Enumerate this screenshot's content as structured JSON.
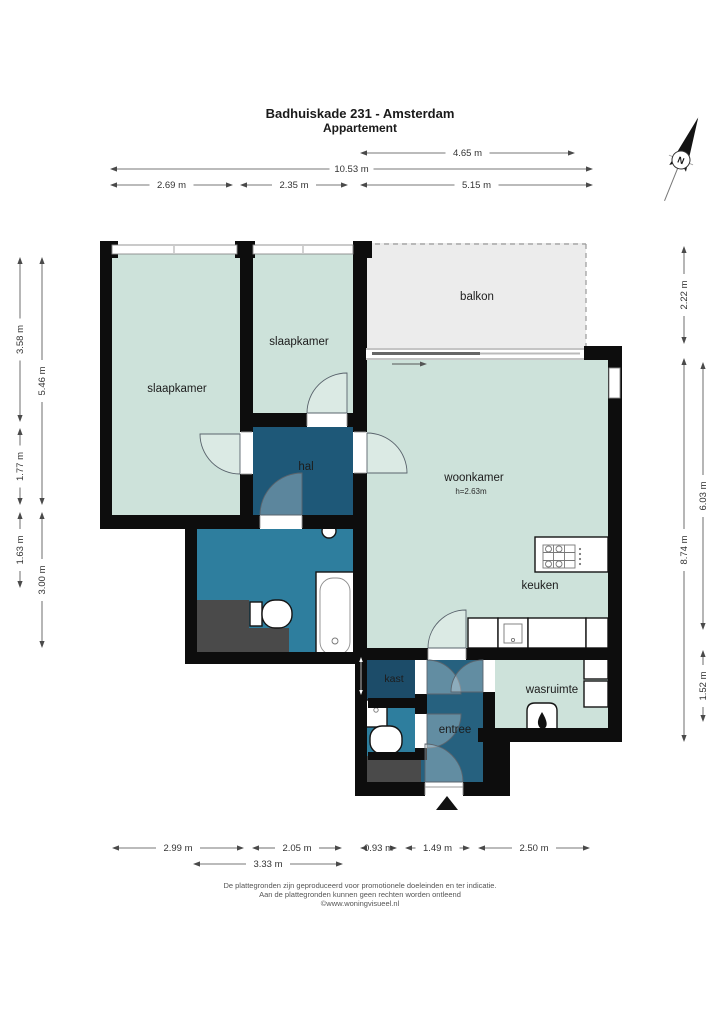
{
  "title": {
    "line1": "Badhuiskade 231 - Amsterdam",
    "line2": "Appartement"
  },
  "compass": {
    "north_letter": "N"
  },
  "rooms": {
    "slaapkamer1": {
      "label": "slaapkamer"
    },
    "slaapkamer2": {
      "label": "slaapkamer"
    },
    "balkon": {
      "label": "balkon"
    },
    "woonkamer": {
      "label": "woonkamer",
      "ceiling_height": "h=2.63m"
    },
    "hal": {
      "label": "hal"
    },
    "keuken": {
      "label": "keuken"
    },
    "kast": {
      "label": "kast"
    },
    "entree": {
      "label": "entree"
    },
    "wasruimte": {
      "label": "wasruimte"
    }
  },
  "dimensions": {
    "top": [
      {
        "label": "4.65 m"
      },
      {
        "label": "10.53 m"
      },
      {
        "label": "2.69 m"
      },
      {
        "label": "2.35 m"
      },
      {
        "label": "5.15 m"
      }
    ],
    "left": [
      {
        "label": "3.58 m"
      },
      {
        "label": "1.77 m"
      },
      {
        "label": "1.63 m"
      },
      {
        "label": "5.46 m"
      },
      {
        "label": "3.00 m"
      }
    ],
    "right": [
      {
        "label": "2.22 m"
      },
      {
        "label": "8.74 m"
      },
      {
        "label": "6.03 m"
      },
      {
        "label": "1.52 m"
      }
    ],
    "bottom": [
      {
        "label": "2.99 m"
      },
      {
        "label": "2.05 m"
      },
      {
        "label": "0.93 m"
      },
      {
        "label": "1.49 m"
      },
      {
        "label": "2.50 m"
      },
      {
        "label": "3.33 m"
      }
    ]
  },
  "footer": {
    "line1": "De plattegronden zijn geproduceerd voor promotionele doeleinden en ter indicatie.",
    "line2": "Aan de plattegronden kunnen geen rechten worden ontleend",
    "line3": "©www.woningvisueel.nl"
  },
  "colors": {
    "wall": "#0d0d0d",
    "room_green": "#cde2da",
    "room_navy": "#1e5878",
    "room_navy_light": "#26617f",
    "room_kast": "#1c4c69",
    "room_teal": "#2e7e9e",
    "balkon_gray": "#ececec",
    "shaft_gray": "#4a4a4a",
    "text": "#1c1c1c"
  }
}
